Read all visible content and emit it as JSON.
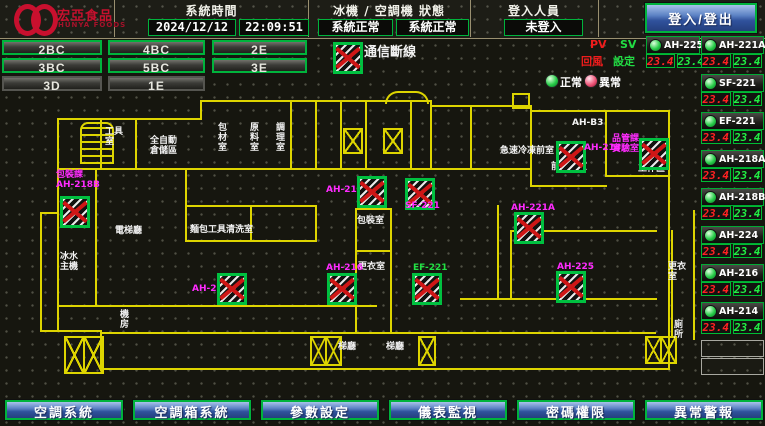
{
  "header": {
    "brand": {
      "name": "宏亞食品",
      "sub": "HUNYA FOODS"
    },
    "time": {
      "label": "系統時間",
      "date": "2024/12/12",
      "clock": "22:09:51"
    },
    "status": {
      "label": "冰機 / 空調機 狀態",
      "chiller": "系統正常",
      "ac": "系統正常"
    },
    "login": {
      "label": "登入人員",
      "user": "未登入",
      "button": "登入/登出"
    }
  },
  "floors": {
    "r1c1": "2BC",
    "r1c2": "4BC",
    "r1c3": "2E",
    "r2c1": "3BC",
    "r2c2": "5BC",
    "r2c3": "3E",
    "r3c1": "3D",
    "r3c2": "1E"
  },
  "legend": {
    "disconnect": "通信斷線",
    "pv": "PV",
    "sv": "SV",
    "pv_name": "回風",
    "sv_name": "設定",
    "normal": "正常",
    "abnormal": "異常"
  },
  "units": [
    {
      "name": "AH-225",
      "pv": "23.4",
      "sv": "23.4"
    },
    {
      "name": "AH-221A",
      "pv": "23.4",
      "sv": "23.4"
    },
    {
      "name": "SF-221",
      "pv": "23.4",
      "sv": "23.4"
    },
    {
      "name": "EF-221",
      "pv": "23.4",
      "sv": "23.4"
    },
    {
      "name": "AH-218A",
      "pv": "23.4",
      "sv": "23.4"
    },
    {
      "name": "AH-218B",
      "pv": "23.4",
      "sv": "23.4"
    },
    {
      "name": "AH-224",
      "pv": "23.4",
      "sv": "23.4"
    },
    {
      "name": "AH-216",
      "pv": "23.4",
      "sv": "23.4"
    },
    {
      "name": "AH-214",
      "pv": "23.4",
      "sv": "23.4"
    }
  ],
  "plan": {
    "devices": [
      {
        "label": "包裝課\nAH-218B"
      },
      {
        "label": "AH-224"
      },
      {
        "label": "AH-218A"
      },
      {
        "label": "SF-221"
      },
      {
        "label": "AH-221A"
      },
      {
        "label": "AH-214"
      },
      {
        "label": "品管課\n實驗室"
      },
      {
        "label": "AH-216"
      },
      {
        "label": "EF-221"
      },
      {
        "label": "AH-225"
      }
    ],
    "rooms": {
      "tool": "工具室",
      "storage": "全自動\n倉儲區",
      "v1": "包材室",
      "v2": "原料室",
      "v3": "調理室",
      "ahb3": "AH-B3",
      "freezer": "急速冷凍前室",
      "pretreat": "前處理室",
      "work": "工作區",
      "packing": "包裝室",
      "locker1": "更衣室",
      "locker2": "更衣室",
      "chiller": "冰水\n主機",
      "elevator": "電梯廳",
      "washing": "麵包工具清洗室",
      "machine": "機\n房",
      "hall1": "梯廳",
      "hall2": "梯廳",
      "toilet": "廁所"
    }
  },
  "nav": [
    "空調系統",
    "空調箱系統",
    "參數設定",
    "儀表監視",
    "密碼權限",
    "異常警報"
  ],
  "colors": {
    "accent_green": "#00b33c",
    "alarm_red": "#cf1616",
    "magenta": "#ff2bff",
    "wall_yellow": "#ddd400",
    "button_blue": "#30529c"
  }
}
